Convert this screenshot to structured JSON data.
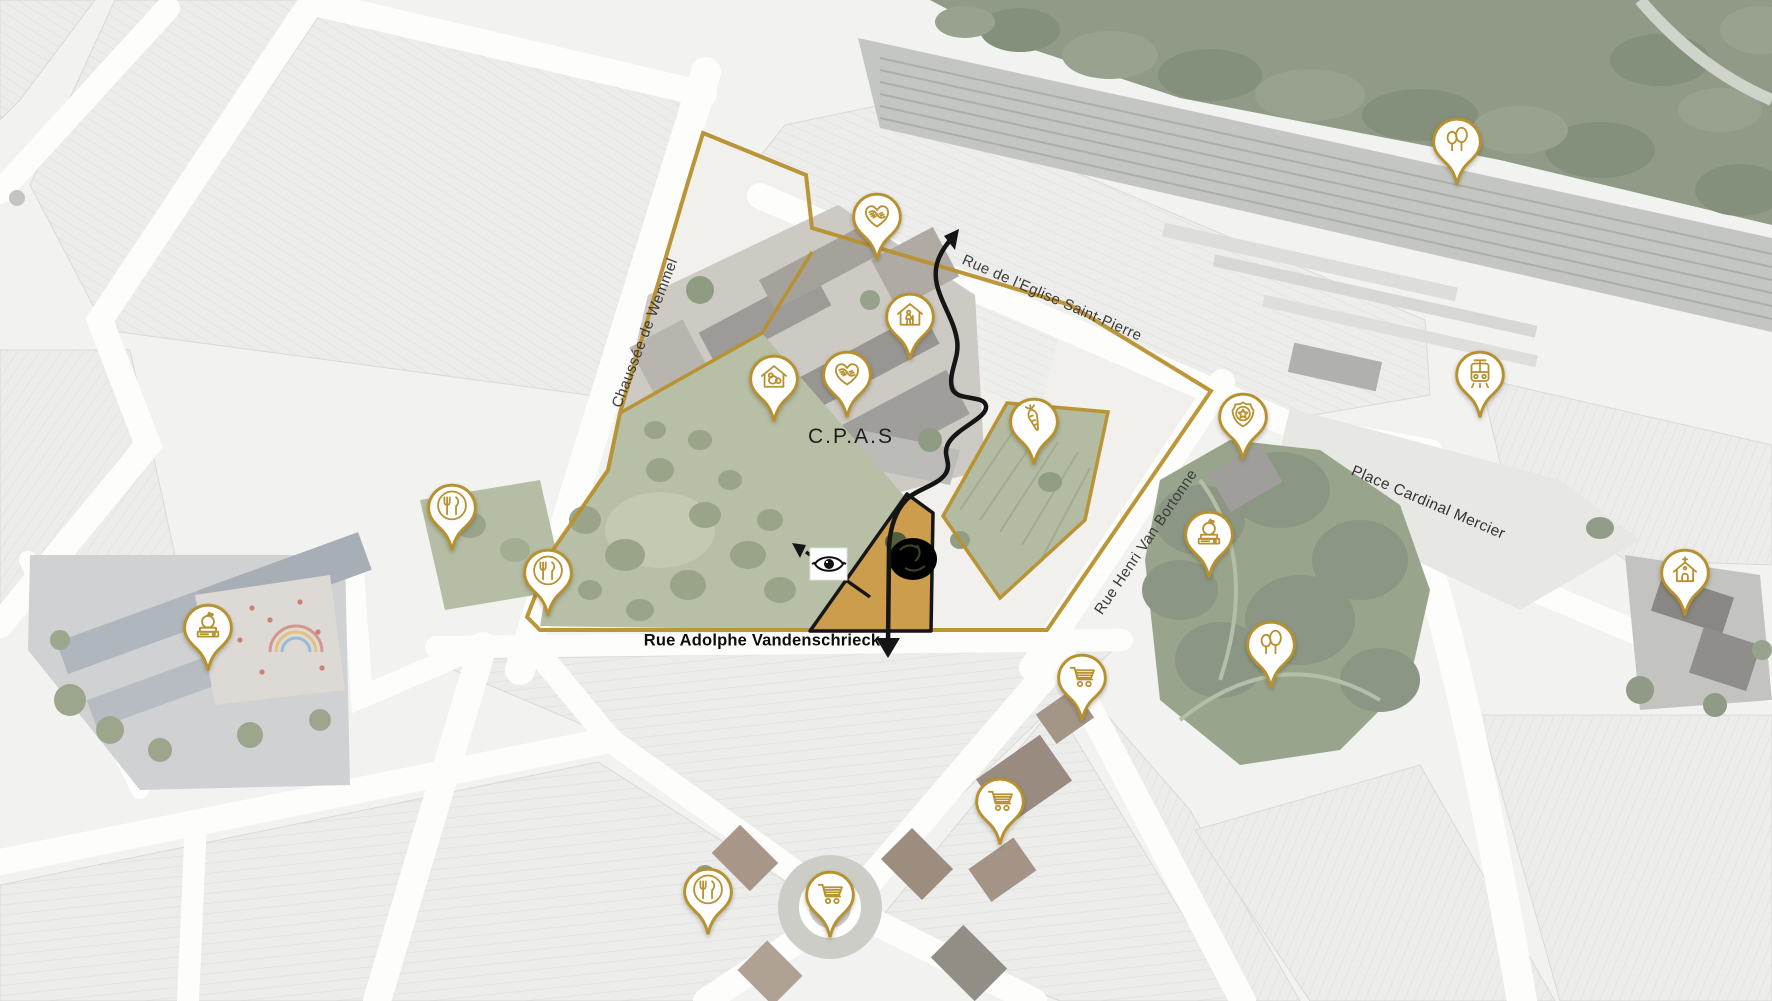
{
  "map": {
    "region_label": "C.P.A.S",
    "streets": {
      "wemmel": "Chaussée de Wemmel",
      "eglise": "Rue de l'Eglise Saint-Pierre",
      "vandenschrieck": "Rue Adolphe Vandenschrieck",
      "bortonne": "Rue Henri Van Bortonne",
      "mercier": "Place Cardinal Mercier"
    },
    "colors": {
      "pin_gold": "#b8912f",
      "boundary_gold": "#b8912f",
      "site_fill": "#c9973f",
      "route_black": "#151515"
    },
    "pins": [
      {
        "icon": "care-hands-heart",
        "x": 877,
        "y": 262
      },
      {
        "icon": "elderly-home",
        "x": 910,
        "y": 362
      },
      {
        "icon": "childcare-home",
        "x": 774,
        "y": 424
      },
      {
        "icon": "care-hands-heart",
        "x": 847,
        "y": 420
      },
      {
        "icon": "vegetable-garden",
        "x": 1034,
        "y": 467
      },
      {
        "icon": "police-badge",
        "x": 1243,
        "y": 462
      },
      {
        "icon": "school",
        "x": 1209,
        "y": 580
      },
      {
        "icon": "school",
        "x": 208,
        "y": 673
      },
      {
        "icon": "restaurant",
        "x": 452,
        "y": 553
      },
      {
        "icon": "restaurant",
        "x": 548,
        "y": 618
      },
      {
        "icon": "restaurant",
        "x": 708,
        "y": 937
      },
      {
        "icon": "park-trees",
        "x": 1457,
        "y": 187
      },
      {
        "icon": "park-trees",
        "x": 1271,
        "y": 690
      },
      {
        "icon": "tram-station",
        "x": 1480,
        "y": 420
      },
      {
        "icon": "church",
        "x": 1685,
        "y": 618
      },
      {
        "icon": "supermarket-cart",
        "x": 1000,
        "y": 847
      },
      {
        "icon": "supermarket-cart",
        "x": 1082,
        "y": 723
      },
      {
        "icon": "supermarket-cart",
        "x": 830,
        "y": 940
      }
    ]
  }
}
